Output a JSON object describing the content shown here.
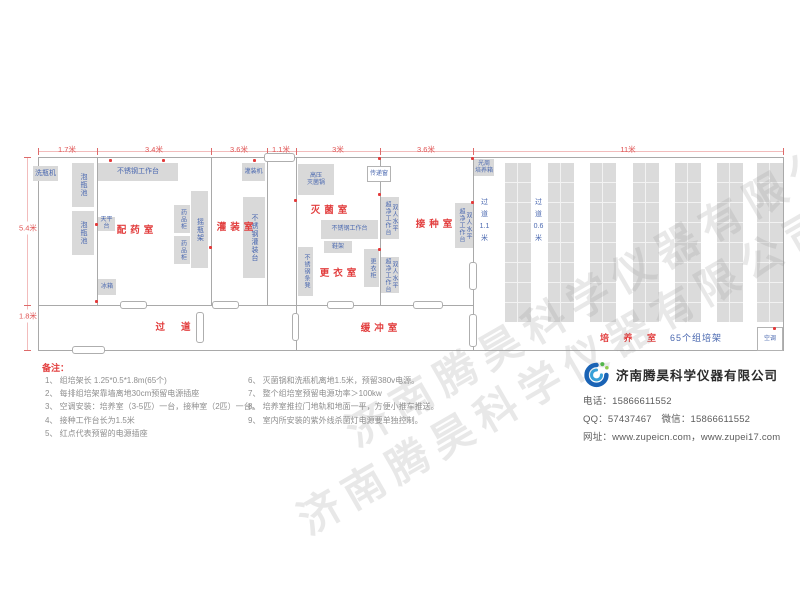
{
  "watermark": {
    "text": "济南腾昊科学仪器有限公司"
  },
  "plan": {
    "walls": [
      [
        38,
        157,
        746,
        1
      ],
      [
        38,
        350,
        746,
        1
      ],
      [
        38,
        157,
        1,
        194
      ],
      [
        783,
        157,
        1,
        194
      ],
      [
        97,
        157,
        1,
        149
      ],
      [
        211,
        157,
        1,
        149
      ],
      [
        267,
        157,
        1,
        149
      ],
      [
        296,
        157,
        1,
        194
      ],
      [
        380,
        157,
        1,
        149
      ],
      [
        473,
        157,
        1,
        194
      ],
      [
        38,
        305,
        436,
        1
      ]
    ],
    "doors": [
      [
        120,
        301,
        27,
        8
      ],
      [
        212,
        301,
        27,
        8
      ],
      [
        327,
        301,
        27,
        8
      ],
      [
        413,
        301,
        30,
        8
      ],
      [
        196,
        312,
        8,
        31
      ],
      [
        292,
        313,
        7,
        28
      ],
      [
        469,
        262,
        8,
        28
      ],
      [
        469,
        314,
        8,
        33
      ],
      [
        72,
        346,
        33,
        8
      ],
      [
        264,
        153,
        31,
        9
      ]
    ],
    "outlets": [
      [
        109,
        159
      ],
      [
        162,
        159
      ],
      [
        253,
        159
      ],
      [
        95,
        223
      ],
      [
        95,
        300
      ],
      [
        209,
        246
      ],
      [
        294,
        199
      ],
      [
        378,
        157
      ],
      [
        378,
        193
      ],
      [
        378,
        248
      ],
      [
        471,
        157
      ],
      [
        471,
        201
      ],
      [
        773,
        327
      ]
    ],
    "shelves": {
      "xs": [
        505,
        548,
        590,
        633,
        675,
        717,
        757
      ],
      "y": 163,
      "w": 26,
      "h": 159
    },
    "equipment": [
      {
        "name": "bottle-washer",
        "label": "洗瓶机",
        "rect": [
          33,
          166,
          25,
          15
        ],
        "type": "h",
        "small": false
      },
      {
        "name": "soak-pool-1",
        "label": "泡瓶池",
        "rect": [
          72,
          163,
          22,
          44
        ],
        "type": "v",
        "small": false
      },
      {
        "name": "soak-pool-2",
        "label": "泡瓶池",
        "rect": [
          72,
          211,
          22,
          44
        ],
        "type": "v",
        "small": false
      },
      {
        "name": "ss-workbench-a",
        "label": "不锈钢工作台",
        "rect": [
          98,
          163,
          80,
          18
        ],
        "type": "h",
        "small": false
      },
      {
        "name": "filling-machine",
        "label": "灌装机",
        "rect": [
          242,
          163,
          23,
          18
        ],
        "type": "h",
        "small": true
      },
      {
        "name": "balance-table",
        "label": "天平台",
        "rect": [
          98,
          217,
          17,
          14
        ],
        "type": "h",
        "small": true
      },
      {
        "name": "medicine-cabinet-1",
        "label": "药品柜",
        "rect": [
          174,
          205,
          16,
          28
        ],
        "type": "v",
        "small": true
      },
      {
        "name": "medicine-cabinet-2",
        "label": "药品柜",
        "rect": [
          174,
          236,
          16,
          28
        ],
        "type": "v",
        "small": true
      },
      {
        "name": "shake-flask-rack",
        "label": "摇瓶架",
        "rect": [
          191,
          191,
          17,
          77
        ],
        "type": "v",
        "small": false
      },
      {
        "name": "fridge",
        "label": "冰箱",
        "rect": [
          98,
          279,
          18,
          16
        ],
        "type": "h",
        "small": true
      },
      {
        "name": "ss-filling-table",
        "label": "不锈钢灌装台",
        "rect": [
          243,
          197,
          22,
          81
        ],
        "type": "v",
        "small": false
      },
      {
        "name": "autoclave",
        "label": "高压\n灭菌锅",
        "rect": [
          298,
          164,
          36,
          31
        ],
        "type": "h",
        "small": true
      },
      {
        "name": "ss-bench",
        "label": "不锈钢条凳",
        "rect": [
          298,
          247,
          15,
          49
        ],
        "type": "v",
        "small": true
      },
      {
        "name": "ss-workbench-b",
        "label": "不锈钢工作台",
        "rect": [
          321,
          220,
          57,
          19
        ],
        "type": "h",
        "small": true
      },
      {
        "name": "shoe-rack",
        "label": "鞋架",
        "rect": [
          324,
          241,
          28,
          12
        ],
        "type": "h",
        "small": true
      },
      {
        "name": "locker",
        "label": "更衣柜",
        "rect": [
          364,
          249,
          15,
          38
        ],
        "type": "v",
        "small": true
      },
      {
        "name": "clean-bench-1",
        "label": "双人水平\n超净工作台",
        "rect": [
          381,
          197,
          18,
          42
        ],
        "type": "v",
        "small": true
      },
      {
        "name": "clean-bench-2",
        "label": "双人水平\n超净工作台",
        "rect": [
          381,
          257,
          18,
          36
        ],
        "type": "v",
        "small": true
      },
      {
        "name": "clean-bench-3",
        "label": "双人水平\n超净工作台",
        "rect": [
          455,
          203,
          18,
          45
        ],
        "type": "v",
        "small": true
      },
      {
        "name": "photoperiod-incubator",
        "label": "光周\n培养箱",
        "rect": [
          474,
          159,
          20,
          17
        ],
        "type": "h",
        "small": true
      }
    ],
    "whiteboxes": [
      {
        "name": "pass-window",
        "label": "传递窗",
        "rect": [
          367,
          166,
          24,
          16
        ]
      },
      {
        "name": "air-conditioner",
        "label": "空调",
        "rect": [
          757,
          327,
          26,
          24
        ]
      }
    ],
    "rooms": [
      {
        "name": "dispensing",
        "label": "配药室",
        "x": 137,
        "y": 229,
        "wide": false
      },
      {
        "name": "filling",
        "label": "灌装室",
        "x": 237,
        "y": 226,
        "wide": false
      },
      {
        "name": "sterilization",
        "label": "灭菌室",
        "x": 331,
        "y": 209,
        "wide": false
      },
      {
        "name": "changing",
        "label": "更衣室",
        "x": 340,
        "y": 272,
        "wide": false
      },
      {
        "name": "inoculation",
        "label": "接种室",
        "x": 436,
        "y": 223,
        "wide": false
      },
      {
        "name": "corridor",
        "label": "过道",
        "x": 181,
        "y": 326,
        "wide": true
      },
      {
        "name": "buffer",
        "label": "缓冲室",
        "x": 381,
        "y": 327,
        "wide": false
      }
    ],
    "aisles": [
      {
        "label": "过\n道\n1.1\n米",
        "rect": [
          478,
          197,
          13,
          52
        ]
      },
      {
        "label": "过\n道\n0.6\n米",
        "rect": [
          532,
          197,
          13,
          52
        ]
      }
    ],
    "dim_top": {
      "line": [
        38,
        151,
        746,
        1
      ],
      "ticks": [
        38,
        97,
        211,
        267,
        296,
        380,
        473,
        783
      ],
      "labels": [
        {
          "t": "1.7米",
          "x": 67
        },
        {
          "t": "3.4米",
          "x": 154
        },
        {
          "t": "3.6米",
          "x": 239
        },
        {
          "t": "1.1米",
          "x": 281
        },
        {
          "t": "3米",
          "x": 338
        },
        {
          "t": "3.6米",
          "x": 426
        },
        {
          "t": "11米",
          "x": 628
        }
      ]
    },
    "dim_left": {
      "line": [
        27,
        157,
        1,
        194
      ],
      "ticks": [
        157,
        305,
        350
      ],
      "labels": [
        {
          "t": "5.4米",
          "y": 228
        },
        {
          "t": "1.8米",
          "y": 316
        }
      ]
    },
    "culture": {
      "label_red": "培 养 室",
      "label_blue": "65个组培架",
      "x": 600,
      "y": 331
    }
  },
  "notes": {
    "title": "备注：",
    "col1": [
      "1、 组培架长 1.25*0.5*1.8m(65个)",
      "2、 每排组培架靠墙离地30cm预留电源插座",
      "3、 空调安装：培养室（3-5匹）一台，接种室（2匹）一台。",
      "4、 接种工作台长为1.5米",
      "5、 红点代表预留的电源插座"
    ],
    "col2": [
      "6、 灭菌锅和洗瓶机离地1.5米，预留380v电源。",
      "7、 整个组培室预留电源功率＞100kw",
      "8、 培养室推拉门地轨和地面一平，方便小推车推送。",
      "9、 室内所安装的紫外线杀菌灯电源要单独控制。"
    ]
  },
  "company": {
    "name": "济南腾昊科学仪器有限公司",
    "phone_line": "电话：15866611552",
    "qq_line": "QQ：57437467　微信：15866611552",
    "web_line": "网址：www.zupeicn.com，www.zupei17.com"
  }
}
